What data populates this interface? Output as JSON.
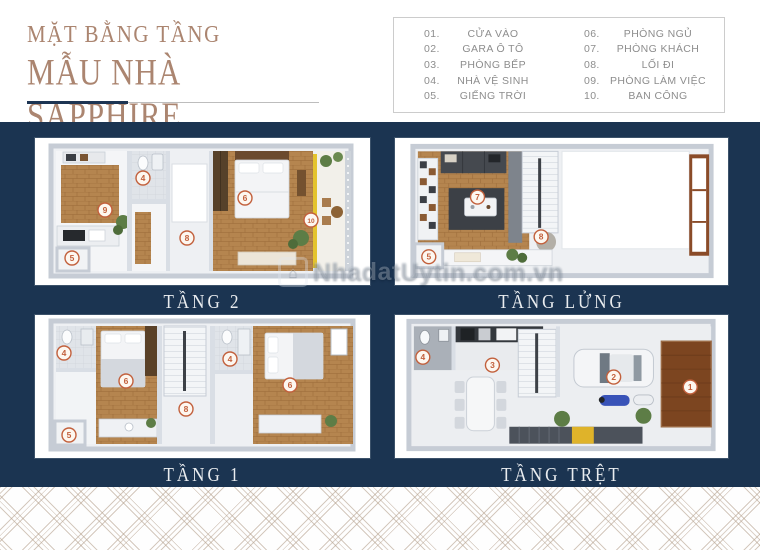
{
  "title": {
    "line1": "MẶT BẰNG TẦNG",
    "line2": "MẪU NHÀ SAPPHIRE"
  },
  "legend": {
    "items": [
      {
        "num": "01.",
        "label": "CỬA VÀO"
      },
      {
        "num": "02.",
        "label": "GARA Ô TÔ"
      },
      {
        "num": "03.",
        "label": "PHÒNG BẾP"
      },
      {
        "num": "04.",
        "label": "NHÀ VỆ SINH"
      },
      {
        "num": "05.",
        "label": "GIẾNG TRỜI"
      },
      {
        "num": "06.",
        "label": "PHÒNG NGỦ"
      },
      {
        "num": "07.",
        "label": "PHÒNG KHÁCH"
      },
      {
        "num": "08.",
        "label": "LỐI ĐI"
      },
      {
        "num": "09.",
        "label": "PHÒNG LÀM VIỆC"
      },
      {
        "num": "10.",
        "label": "BAN CÔNG"
      }
    ]
  },
  "watermark": {
    "text": "NhadatUytin.com.vn"
  },
  "plans": [
    {
      "id": "tang-2",
      "label": "TẦNG 2",
      "badges": [
        {
          "n": "9",
          "x": 70,
          "y": 72
        },
        {
          "n": "4",
          "x": 108,
          "y": 40
        },
        {
          "n": "5",
          "x": 37,
          "y": 120
        },
        {
          "n": "8",
          "x": 152,
          "y": 100
        },
        {
          "n": "6",
          "x": 210,
          "y": 60
        },
        {
          "n": "10",
          "x": 276,
          "y": 82
        }
      ]
    },
    {
      "id": "tang-lung",
      "label": "TẦNG LỬNG",
      "badges": [
        {
          "n": "7",
          "x": 83,
          "y": 59
        },
        {
          "n": "8",
          "x": 147,
          "y": 99
        },
        {
          "n": "5",
          "x": 34,
          "y": 119
        }
      ]
    },
    {
      "id": "tang-1",
      "label": "TẦNG 1",
      "badges": [
        {
          "n": "4",
          "x": 29,
          "y": 38
        },
        {
          "n": "6",
          "x": 91,
          "y": 66
        },
        {
          "n": "5",
          "x": 34,
          "y": 120
        },
        {
          "n": "8",
          "x": 151,
          "y": 94
        },
        {
          "n": "4",
          "x": 195,
          "y": 44
        },
        {
          "n": "6",
          "x": 255,
          "y": 70
        }
      ]
    },
    {
      "id": "tang-tret",
      "label": "TẦNG TRỆT",
      "badges": [
        {
          "n": "4",
          "x": 28,
          "y": 42
        },
        {
          "n": "3",
          "x": 98,
          "y": 50
        },
        {
          "n": "2",
          "x": 220,
          "y": 62
        },
        {
          "n": "1",
          "x": 297,
          "y": 72
        }
      ]
    }
  ],
  "colors": {
    "navy": "#1b3451",
    "title_tan": "#ab8570",
    "badge": "#c2603c",
    "wood": "#b5854f",
    "yellow_accent": "#e4c32e",
    "legend_text": "#8d8d8d"
  }
}
